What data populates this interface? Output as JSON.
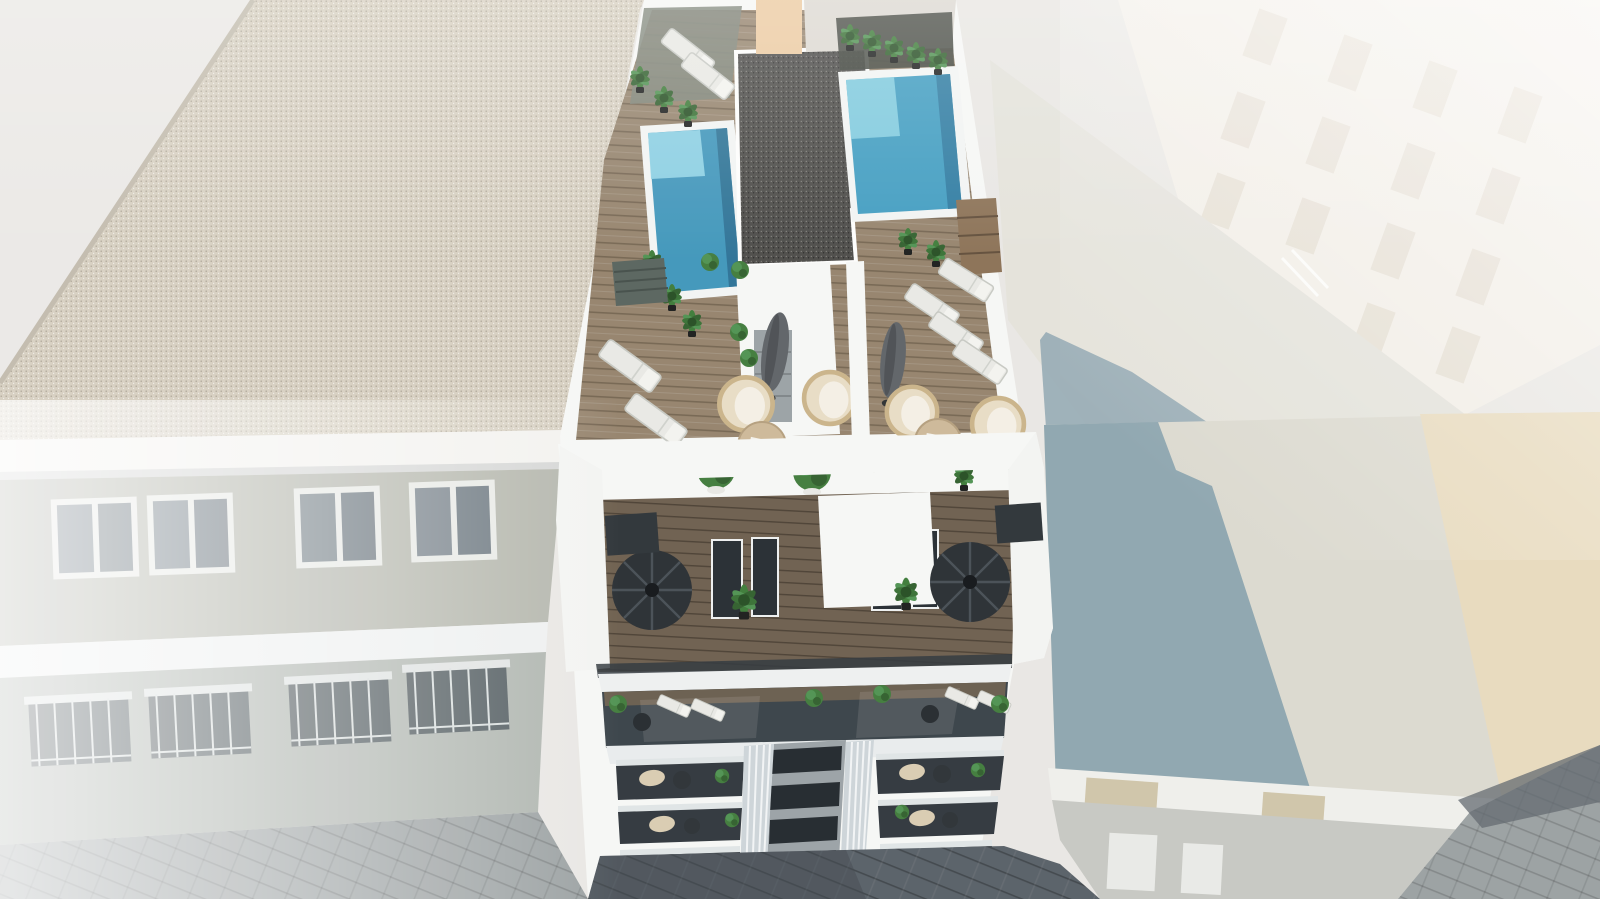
{
  "scene": {
    "type": "architectural-3d-render",
    "view": "aerial bird's-eye",
    "description": "New-build white apartment block with rooftop pools and terraces, seen from above between neighboring buildings and paved streets",
    "objects": {
      "rooftop_pools": 2,
      "rooftop_terrace_units": 2,
      "spiral_staircases": 2,
      "facade_balcony_columns": 2,
      "sun_loungers": 9,
      "hanging_chairs": 4,
      "parasols": 2,
      "round_tables": 2,
      "potted_plants": 30
    }
  },
  "palette": {
    "background": "#e9e7e3",
    "corner_roof": "#ebe9e6",
    "gravel_beige": "#d7d0c1",
    "gravel_dark": "#4a4946",
    "white_wall": "#f6f7f5",
    "fascia": "#f3f2ef",
    "slab": "#eef0f0",
    "neighbor_brick_upper": "#b3b5ab",
    "neighbor_brick_lower": "#aeb4ae",
    "window_glass": "#77828a",
    "balcony_dark": "#4e585c",
    "street_light": "#9aa0a1",
    "street_dark": "#565e65",
    "deck_wood": "#94826b",
    "deck_wood_dark": "#6c5d4c",
    "deck_gray_green": "#7c8277",
    "pool_water": "#3e95ba",
    "pool_ledge": "#8ed2e4",
    "pool_deep": "#2b7195",
    "pool_coping": "#f2f4f3",
    "plant_green": "#3f7a3a",
    "plant_dark": "#2f5e2b",
    "plant_light": "#4e9150",
    "soil_dark": "#3c4038",
    "furniture_white": "#e9e9e4",
    "rattan": "#ead9ba",
    "rattan_stroke": "#c9b288",
    "table_wood": "#cdb897",
    "umbrella": "#5d6165",
    "stair_dark": "#272c30",
    "glass_front": "#2e353b",
    "glass_band": "#374046",
    "pilaster": "#ccd4d8",
    "window_dark": "#20262b",
    "steps_wood": "#8a7054",
    "peach_wall": "#ecca9f",
    "gray_wall": "#dcd8d1",
    "right_building": "#f2eee7",
    "right_building_window": "#e4ddd0",
    "right_roof_pale": "#e4e2da",
    "right_wall_pale": "#dbd9cf",
    "right_wall_beige": "#e8dabd",
    "right_wall_shadow": "#8da5ae",
    "cast_shadow_roof": "#93a9b2",
    "cornice": "#efefeb",
    "shop_band": "#c6c7c2",
    "ornament_stone": "#cfc4a8"
  }
}
